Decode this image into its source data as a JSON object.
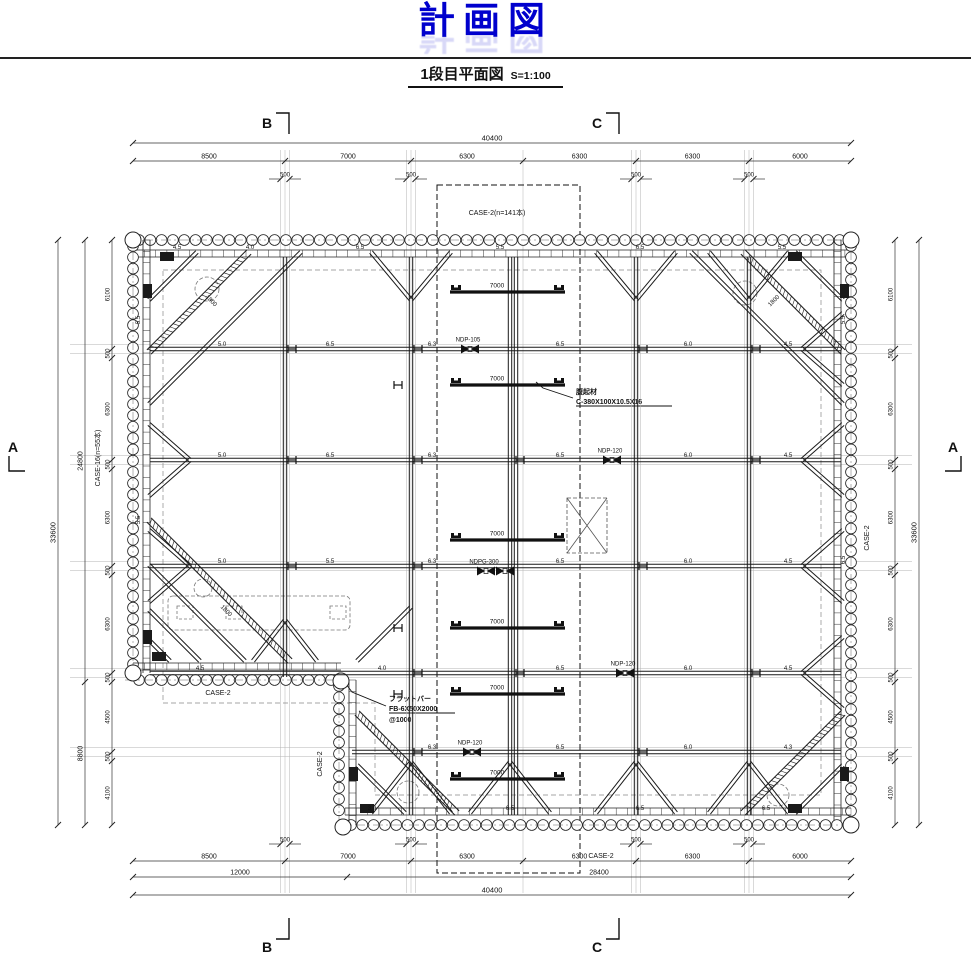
{
  "title": "計画図",
  "subtitle": {
    "label": "1段目平面図",
    "scale": "S=1:100"
  },
  "section_markers": {
    "top_b": "B",
    "top_c": "C",
    "bottom_b": "B",
    "bottom_c": "C",
    "left_a": "A",
    "right_a": "A"
  },
  "case_labels": {
    "top_zone": "CASE-2(n=141本)",
    "left_wall": "CASE-16(n=55本)",
    "right_wall": "CASE-2",
    "step_lower": "CASE-2",
    "step_side": "CASE-2",
    "bottom_zone": "CASE-2"
  },
  "annotations": {
    "flat_bar": [
      "フラットバー",
      "FB-6X50X2000",
      "@1000"
    ],
    "channel": [
      "腹起材",
      "C-380X100X10.5X16"
    ]
  },
  "dimensions": {
    "top": {
      "overall": "40400",
      "chain": [
        "8500",
        "7000",
        "6300",
        "6300",
        "6300",
        "6000"
      ],
      "offset": "500"
    },
    "bottom": {
      "overall": "40400",
      "chain": [
        "8500",
        "7000",
        "6300",
        "6300",
        "6300",
        "6000"
      ],
      "mid": [
        "12000",
        "28400"
      ],
      "offset": "500"
    },
    "left": {
      "overall": "33600",
      "mid": [
        "24800",
        "8800"
      ],
      "chain": [
        "6100",
        "500",
        "6300",
        "500",
        "6300",
        "500",
        "6300",
        "500",
        "4500",
        "500",
        "4100"
      ]
    },
    "right": {
      "overall": "33600",
      "chain": [
        "6100",
        "500",
        "6300",
        "500",
        "6300",
        "500",
        "6300",
        "500",
        "4500",
        "500",
        "4100"
      ]
    }
  },
  "equipment": {
    "strut_bar_label": "7000",
    "jacks": [
      {
        "label": "NDP-105",
        "x": 470,
        "y": 349
      },
      {
        "label": "NDP-120",
        "x": 612,
        "y": 460
      },
      {
        "label": "NDPG-300",
        "x": 486,
        "y": 571,
        "double": true
      },
      {
        "label": "NDP-120",
        "x": 625,
        "y": 673
      },
      {
        "label": "NDP-120",
        "x": 472,
        "y": 752
      }
    ]
  },
  "panel_labels": [
    {
      "t": "4.5",
      "x": 177,
      "y": 249
    },
    {
      "t": "4.0",
      "x": 250,
      "y": 249
    },
    {
      "t": "6.5",
      "x": 360,
      "y": 249
    },
    {
      "t": "5.5",
      "x": 500,
      "y": 249
    },
    {
      "t": "6.5",
      "x": 640,
      "y": 249
    },
    {
      "t": "5.5",
      "x": 782,
      "y": 249
    },
    {
      "t": "5.0",
      "x": 222,
      "y": 346
    },
    {
      "t": "6.5",
      "x": 330,
      "y": 346
    },
    {
      "t": "6.3",
      "x": 432,
      "y": 346
    },
    {
      "t": "6.5",
      "x": 560,
      "y": 346
    },
    {
      "t": "6.0",
      "x": 688,
      "y": 346
    },
    {
      "t": "4.5",
      "x": 788,
      "y": 346
    },
    {
      "t": "5.0",
      "x": 222,
      "y": 457
    },
    {
      "t": "6.5",
      "x": 330,
      "y": 457
    },
    {
      "t": "6.3",
      "x": 432,
      "y": 457
    },
    {
      "t": "6.5",
      "x": 560,
      "y": 457
    },
    {
      "t": "6.0",
      "x": 688,
      "y": 457
    },
    {
      "t": "4.5",
      "x": 788,
      "y": 457
    },
    {
      "t": "5.0",
      "x": 222,
      "y": 563
    },
    {
      "t": "5.5",
      "x": 330,
      "y": 563
    },
    {
      "t": "6.3",
      "x": 432,
      "y": 563
    },
    {
      "t": "6.5",
      "x": 560,
      "y": 563
    },
    {
      "t": "6.0",
      "x": 688,
      "y": 563
    },
    {
      "t": "4.5",
      "x": 788,
      "y": 563
    },
    {
      "t": "4.5",
      "x": 200,
      "y": 670
    },
    {
      "t": "4.0",
      "x": 382,
      "y": 670
    },
    {
      "t": "6.5",
      "x": 560,
      "y": 670
    },
    {
      "t": "6.0",
      "x": 688,
      "y": 670
    },
    {
      "t": "4.5",
      "x": 788,
      "y": 670
    },
    {
      "t": "6.3",
      "x": 432,
      "y": 749
    },
    {
      "t": "6.5",
      "x": 560,
      "y": 749
    },
    {
      "t": "6.0",
      "x": 688,
      "y": 749
    },
    {
      "t": "4.3",
      "x": 788,
      "y": 749
    },
    {
      "t": "3.0",
      "x": 372,
      "y": 810
    },
    {
      "t": "6.5",
      "x": 510,
      "y": 810
    },
    {
      "t": "6.5",
      "x": 640,
      "y": 810
    },
    {
      "t": "6.5",
      "x": 766,
      "y": 810
    },
    {
      "t": "5.5",
      "x": 140,
      "y": 320,
      "r": -90
    },
    {
      "t": "5.5",
      "x": 140,
      "y": 520,
      "r": -90
    },
    {
      "t": "5.5",
      "x": 845,
      "y": 320,
      "r": -90
    },
    {
      "t": "6.5",
      "x": 845,
      "y": 560,
      "r": -90
    },
    {
      "t": "1800",
      "x": 210,
      "y": 302,
      "r": 45
    },
    {
      "t": "1800",
      "x": 225,
      "y": 612,
      "r": 45
    },
    {
      "t": "1800",
      "x": 775,
      "y": 302,
      "r": -45
    }
  ]
}
